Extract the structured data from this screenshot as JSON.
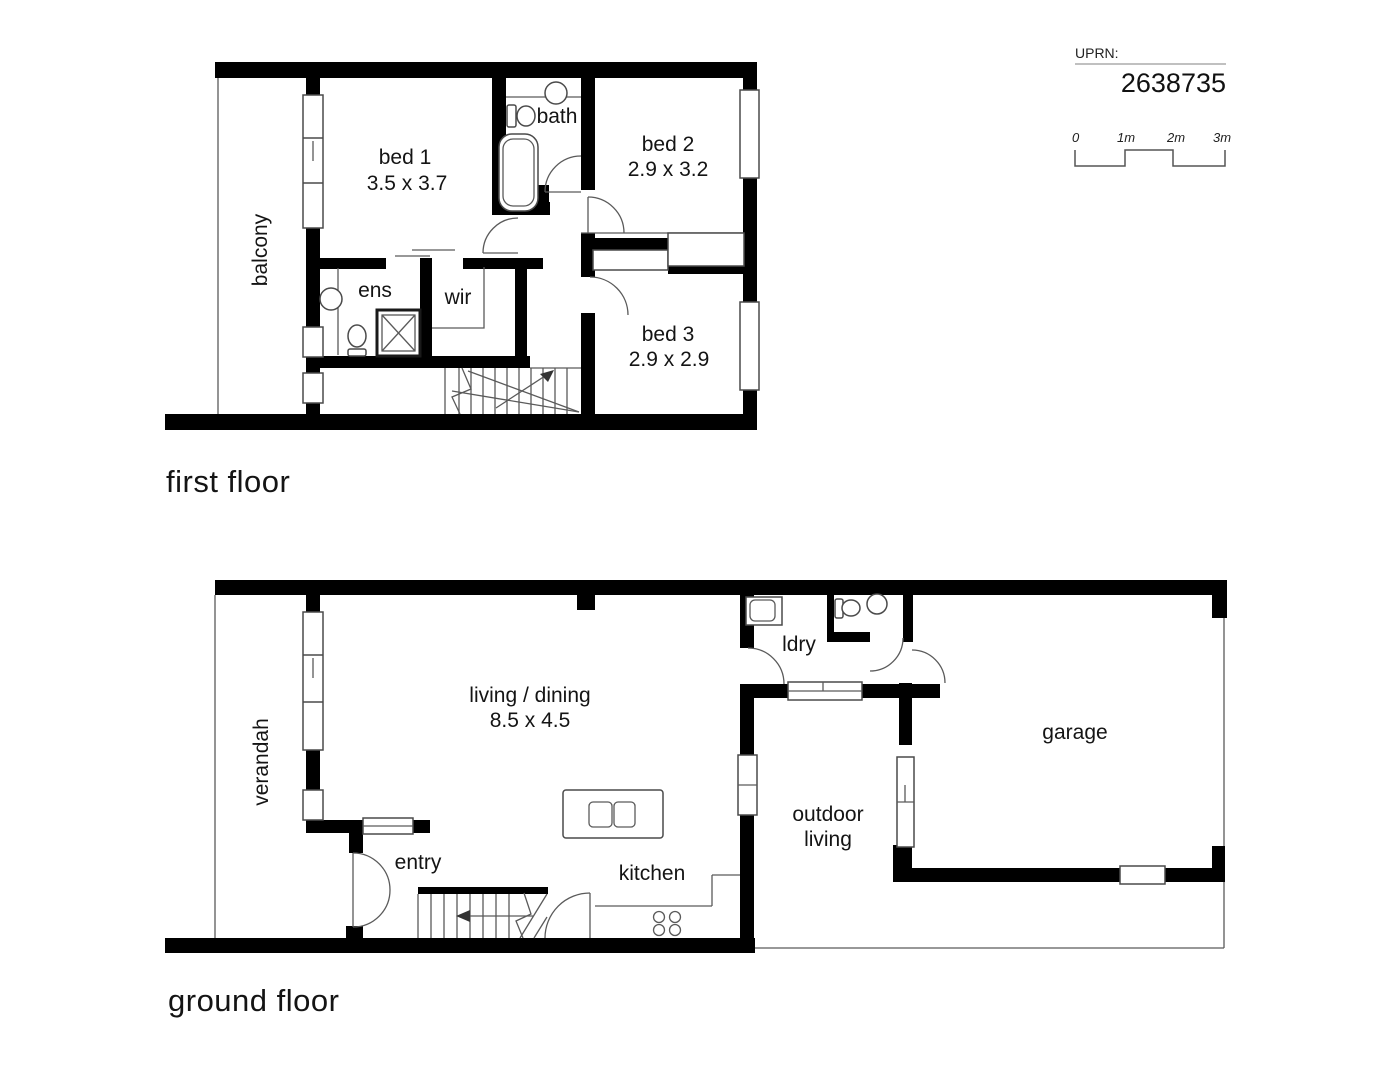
{
  "uprn": {
    "label": "UPRN:",
    "value": "2638735"
  },
  "scale_bar": {
    "ticks": [
      "0",
      "1m",
      "2m",
      "3m"
    ]
  },
  "floors": {
    "first": {
      "title": "first floor",
      "rooms": {
        "balcony": {
          "label": "balcony"
        },
        "bed1": {
          "label": "bed 1",
          "dimensions": "3.5 x 3.7"
        },
        "bath": {
          "label": "bath"
        },
        "bed2": {
          "label": "bed 2",
          "dimensions": "2.9 x 3.2"
        },
        "ens": {
          "label": "ens"
        },
        "wir": {
          "label": "wir"
        },
        "bed3": {
          "label": "bed 3",
          "dimensions": "2.9 x 2.9"
        }
      }
    },
    "ground": {
      "title": "ground floor",
      "rooms": {
        "verandah": {
          "label": "verandah"
        },
        "living_dining": {
          "label": "living / dining",
          "dimensions": "8.5 x 4.5"
        },
        "entry": {
          "label": "entry"
        },
        "kitchen": {
          "label": "kitchen"
        },
        "ldry": {
          "label": "ldry"
        },
        "outdoor_living": {
          "line1": "outdoor",
          "line2": "living"
        },
        "garage": {
          "label": "garage"
        }
      }
    }
  },
  "colors": {
    "wall": "#000000",
    "thin_line": "#4a4a4a",
    "text": "#141414",
    "background": "#ffffff"
  }
}
